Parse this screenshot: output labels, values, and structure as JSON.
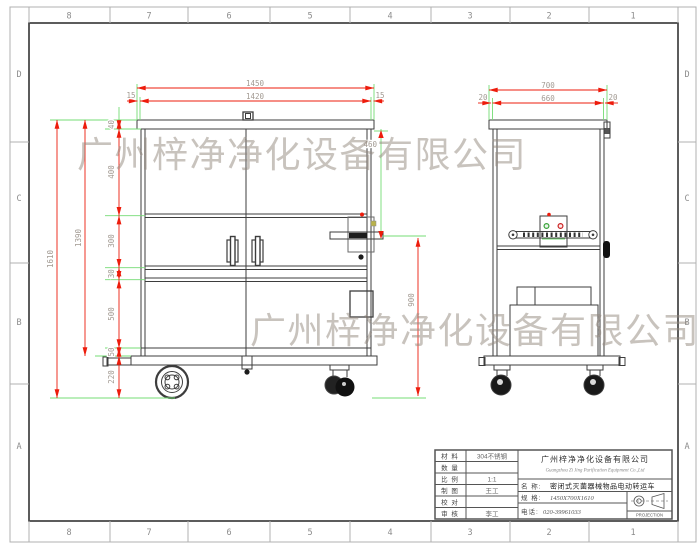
{
  "grid": {
    "cols": [
      "8",
      "7",
      "6",
      "5",
      "4",
      "3",
      "2",
      "1"
    ],
    "rows": [
      "D",
      "C",
      "B",
      "A"
    ]
  },
  "watermark": {
    "line1": "广州梓净净化设备有限公司",
    "line2": "广州梓净净化设备有限公司"
  },
  "dims": {
    "w_total": "1450",
    "w_body": "1420",
    "w_margin_l": "15",
    "w_margin_r": "15",
    "sw_total": "700",
    "sw_body": "660",
    "sw_margin_l": "20",
    "sw_margin_r": "20",
    "h_total": "1610",
    "h_body": "1390",
    "h_lid": "40",
    "h_sec1": "400",
    "h_sec2": "300",
    "h_sec3": "30",
    "h_sec4": "500",
    "h_sec5": "50",
    "h_ground": "220",
    "h_top_handle": "460",
    "h_handle": "900"
  },
  "title_block": {
    "rows": [
      {
        "label": "材 料",
        "value": "304不锈钢"
      },
      {
        "label": "数 量",
        "value": ""
      },
      {
        "label": "比 例",
        "value": "1:1"
      },
      {
        "label": "制 图",
        "value": "王工"
      },
      {
        "label": "校 对",
        "value": ""
      },
      {
        "label": "审 核",
        "value": "李工"
      }
    ],
    "company_cn": "广州梓净净化设备有限公司",
    "company_en": "Guangzhou Zi Jing Purification Equipment Co.,Ltd",
    "name_label": "名 称:",
    "name_value": "密闭式灭菌器械物品电动转运车",
    "spec_label": "规 格:",
    "spec_value": "1450X700X1610",
    "phone_label": "电话:",
    "phone_value": "020-39961033",
    "projection": "PROJECTION"
  },
  "colors": {
    "dim_red": "#ed1c0c",
    "ext_green": "#74dc74",
    "dim_text": "#a29a92",
    "drawing_line": "#3d3d3d",
    "watermark": "#93887e"
  }
}
